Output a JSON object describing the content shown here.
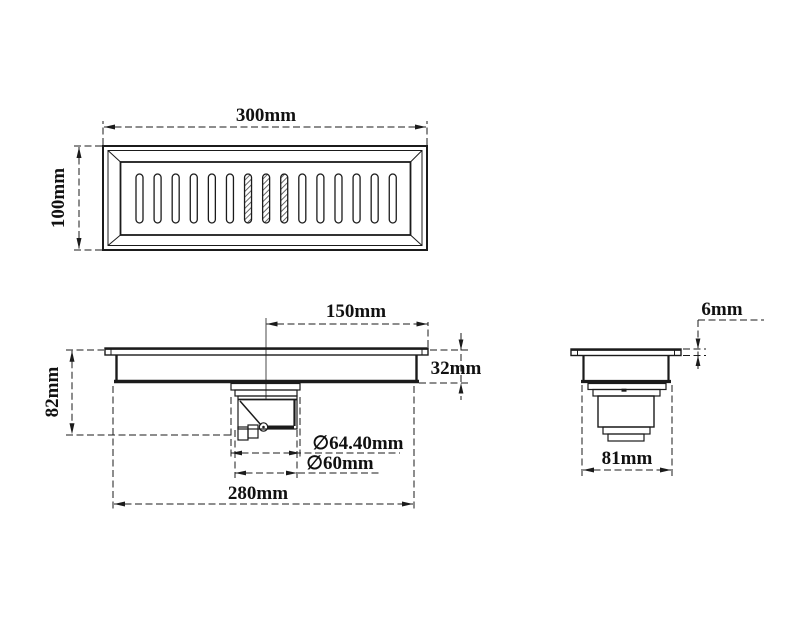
{
  "drawing": {
    "type": "technical-drawing",
    "subject": "linear floor drain with grate and waste trap",
    "background_color": "#ffffff",
    "line_color": "#1b1b1b",
    "views": {
      "top": {
        "name": "top-view-grate",
        "slot_count": 15,
        "hatched_slots": [
          6,
          7,
          8
        ],
        "dims": {
          "width": "300mm",
          "height": "100mm"
        }
      },
      "front": {
        "name": "front-section-view",
        "dims": {
          "center_to_edge": "150mm",
          "channel_depth": "32mm",
          "overall_depth": "82mm",
          "outlet_outer_dia": "∅64.40mm",
          "outlet_inner_dia": "∅60mm",
          "base_width": "280mm"
        }
      },
      "side": {
        "name": "end-view",
        "dims": {
          "flange_thickness": "6mm",
          "base_width": "81mm"
        }
      }
    }
  }
}
